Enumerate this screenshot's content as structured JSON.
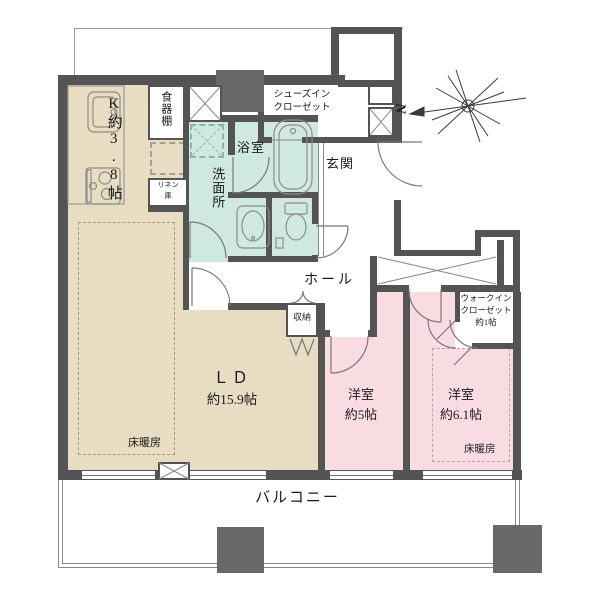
{
  "plan_title": "apartment-floor-plan",
  "colors": {
    "wall": "#545454",
    "kitchen_living_tan": "#e8dcc2",
    "sanitary_mint": "#cfe9e0",
    "bedroom_pink": "#f9dce2",
    "pillar_gray": "#686868",
    "background": "#ffffff"
  },
  "compass": {
    "north_label": "N"
  },
  "rooms": {
    "kitchen": {
      "label": "K約3.8帖"
    },
    "cupboard": {
      "label": "食器棚"
    },
    "linen": {
      "line1": "リネン",
      "line2": "庫"
    },
    "shoes_closet": {
      "line1": "シューズイン",
      "line2": "クローゼット"
    },
    "bath": {
      "label": "浴室"
    },
    "washroom": {
      "label": "洗面所"
    },
    "entrance": {
      "label": "玄関"
    },
    "hall": {
      "label": "ホール"
    },
    "storage": {
      "label": "収納"
    },
    "living": {
      "line1": "ＬＤ",
      "line2": "約15.9帖",
      "floor_heating": "床暖房"
    },
    "west5": {
      "line1": "洋室",
      "line2": "約5帖"
    },
    "west6": {
      "line1": "洋室",
      "line2": "約6.1帖",
      "floor_heating": "床暖房"
    },
    "wic": {
      "line1": "ウォークイン",
      "line2": "クローゼット",
      "line3": "約1帖"
    },
    "balcony": {
      "label": "バルコニー"
    }
  }
}
